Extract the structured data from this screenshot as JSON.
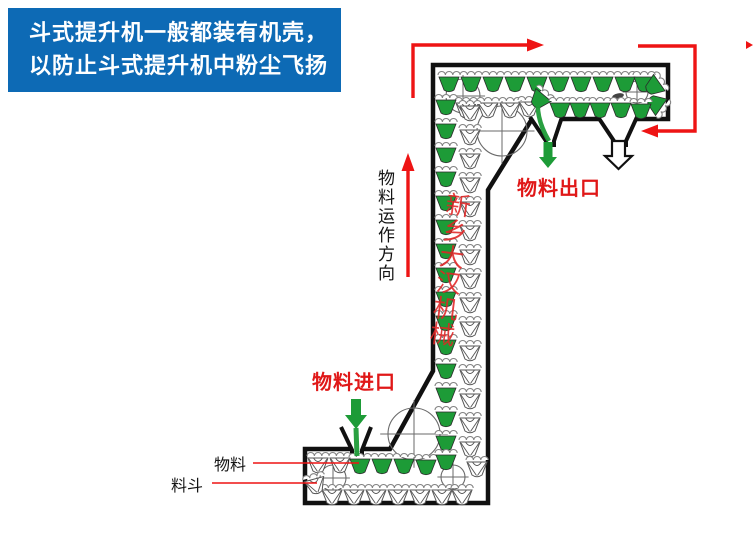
{
  "banner": {
    "line1": "斗式提升机一般都装有机壳，",
    "line2": "以防止斗式提升机中粉尘飞扬",
    "bg_color": "#0d6ab5",
    "text_color": "#ffffff"
  },
  "labels": {
    "direction": "物料运作方向",
    "outlet": "物料出口",
    "inlet": "物料进口",
    "material": "物料",
    "bucket": "料斗",
    "watermark": "新乡大汉机械"
  },
  "colors": {
    "arrow_red": "#ee1414",
    "label_red": "#e01818",
    "watermark_red": "#e12525",
    "bucket_green": "#1d9b37",
    "housing_black": "#111111",
    "wheel_gray": "#6a6a6a",
    "lip_gray": "#828282",
    "text_black": "#141414"
  }
}
